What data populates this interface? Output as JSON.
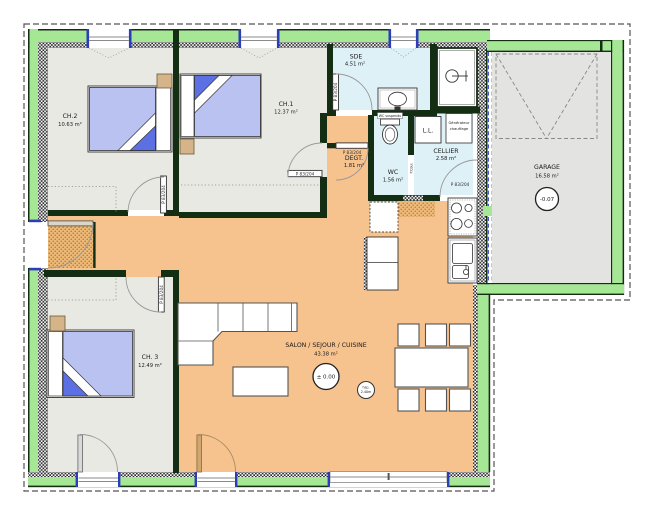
{
  "plan": {
    "rooms": {
      "ch2": {
        "name": "CH.2",
        "area": "10.63 m²"
      },
      "ch1": {
        "name": "CH.1",
        "area": "12.37 m²"
      },
      "ch3": {
        "name": "CH. 3",
        "area": "12.49 m²"
      },
      "sde": {
        "name": "SDE",
        "area": "4.51 m²"
      },
      "wc": {
        "name": "WC",
        "area": "1.56 m²"
      },
      "degt": {
        "name": "DEGT.",
        "area": "1.81 m²"
      },
      "cellier": {
        "name": "CELLIER",
        "area": "2.58 m²"
      },
      "salon": {
        "name": "SALON / SEJOUR / CUISINE",
        "area": "43.38 m²"
      },
      "garage": {
        "name": "GARAGE",
        "area": "16.58 m²"
      }
    },
    "annotations": {
      "door_tag": "P 83/204",
      "sliding_door_tag": "P.Coul.",
      "wc_type": "WC suspendu",
      "washer": "L.L.",
      "heater_line1": "Générateur",
      "heater_line2": "chauffage",
      "level_main": "± 0.00",
      "level_garage": "-0.07",
      "ceiling_height_line1": "hsp.",
      "ceiling_height_line2": "2.40m"
    },
    "colors": {
      "wall_green": "#a5e794",
      "wall_dark": "#142e14",
      "floor_living": "#f6c28e",
      "floor_bedroom": "#e9e9e4",
      "floor_wet": "#def1f6",
      "floor_garage": "#e3e3e1",
      "bed_blanket": "#b9c2f1",
      "bed_fold": "#5c6fe3",
      "window_jamb_blue": "#2b3db8"
    }
  }
}
